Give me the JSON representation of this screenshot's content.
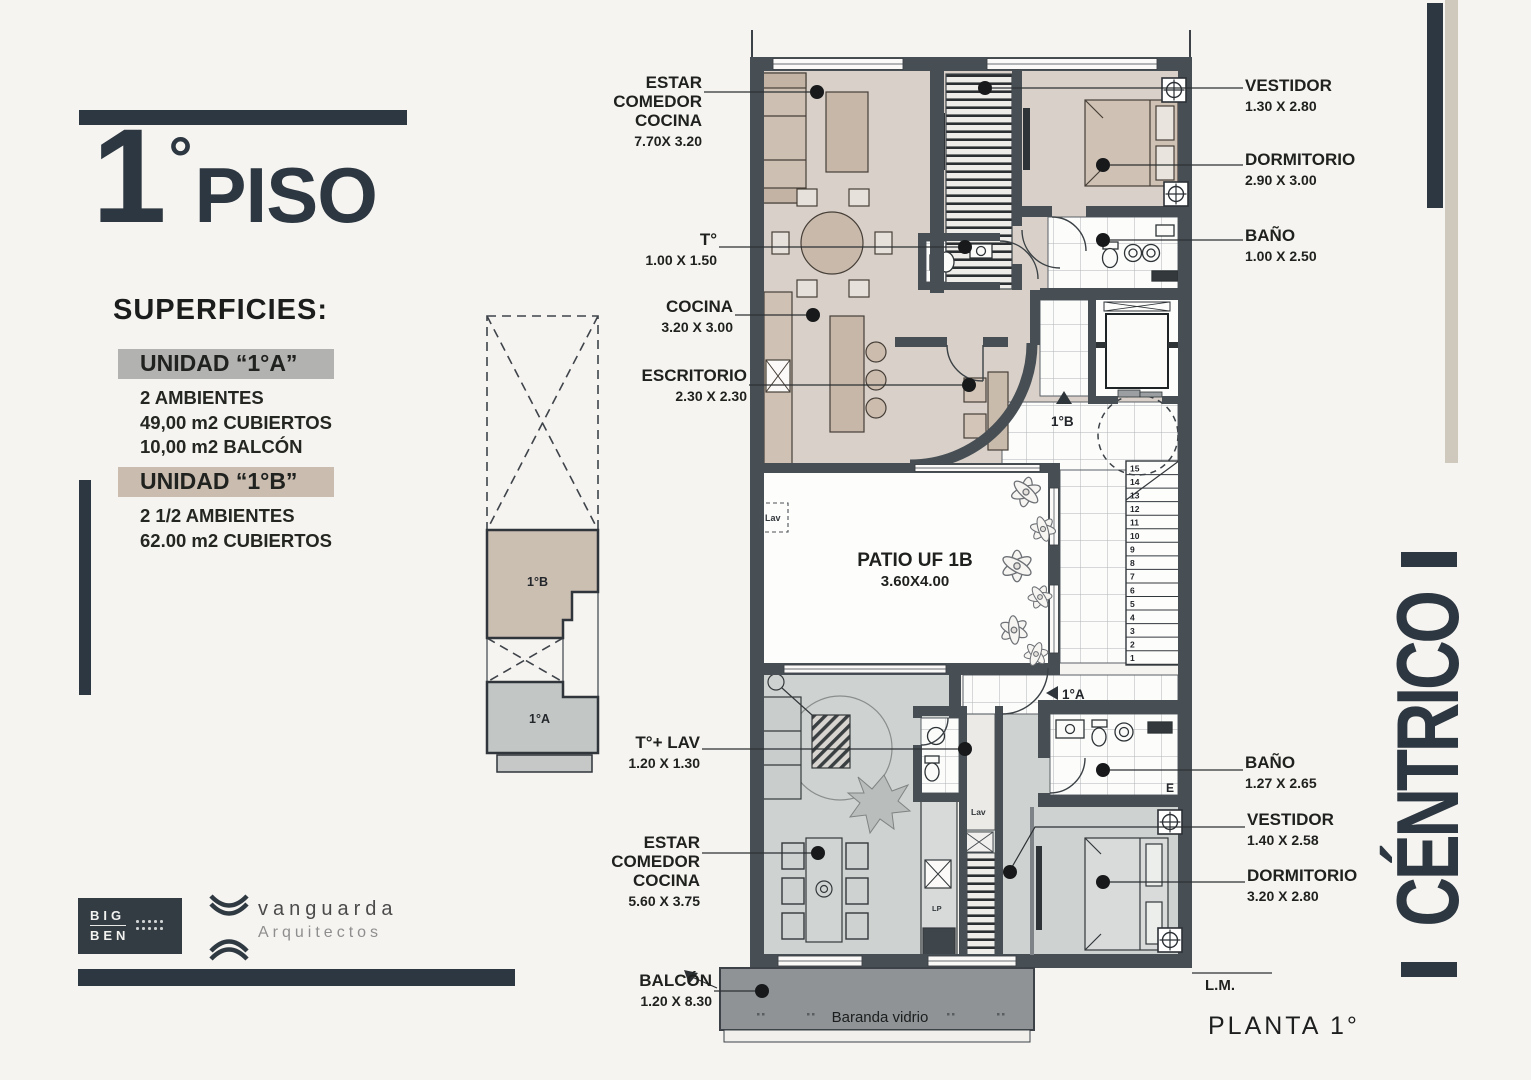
{
  "palette": {
    "accent_dark": "#2d3741",
    "wall": "#474f55",
    "floor_unit_b": "#d9d1c9",
    "floor_unit_a": "#ced2d0",
    "highlight_unit_a": "#b2b2b0",
    "highlight_unit_b": "#cabdb0",
    "balcony_band": "#8f9396",
    "tan_bar": "#cfc8bd"
  },
  "left_panel": {
    "title_digit": "1",
    "title_degree": "°",
    "title_word": "PISO",
    "superficies_heading": "SUPERFICIES:",
    "units": [
      {
        "header": "UNIDAD “1°A”",
        "highlight": "#b2b2b0",
        "lines": [
          "2 AMBIENTES",
          "49,00 m2 CUBIERTOS",
          "10,00 m2 BALCÓN"
        ]
      },
      {
        "header": "UNIDAD “1°B”",
        "highlight": "#cabdb0",
        "lines": [
          "2 1/2 AMBIENTES",
          "62.00 m2 CUBIERTOS"
        ]
      }
    ]
  },
  "keyplan": {
    "unit_b": "1°B",
    "unit_a": "1°A"
  },
  "logos": {
    "bigben_top": "BIG",
    "bigben_bottom": "BEN",
    "vanguarda_name": "vanguarda",
    "vanguarda_sub": "Arquitectos"
  },
  "side_banner": {
    "text": "CÉNTRICO"
  },
  "plan": {
    "labels": {
      "estar_1b": {
        "name": "ESTAR\nCOMEDOR\nCOCINA",
        "dim": "7.70X 3.20"
      },
      "t_1b": {
        "name": "T°",
        "dim": "1.00 X 1.50"
      },
      "cocina_1b": {
        "name": "COCINA",
        "dim": "3.20 X 3.00"
      },
      "escritorio_1b": {
        "name": "ESCRITORIO",
        "dim": "2.30 X 2.30"
      },
      "vestidor_1b": {
        "name": "VESTIDOR",
        "dim": "1.30 X 2.80"
      },
      "dormitorio_1b": {
        "name": "DORMITORIO",
        "dim": "2.90 X 3.00"
      },
      "bano_1b": {
        "name": "BAÑO",
        "dim": "1.00 X 2.50"
      },
      "patio": {
        "name": "PATIO UF 1B",
        "dim": "3.60X4.00"
      },
      "t_lav_1a": {
        "name": "T°+ LAV",
        "dim": "1.20 X 1.30"
      },
      "estar_1a": {
        "name": "ESTAR\nCOMEDOR\nCOCINA",
        "dim": "5.60 X 3.75"
      },
      "balcon": {
        "name": "BALCÓN",
        "dim": "1.20 X 8.30"
      },
      "bano_1a": {
        "name": "BAÑO",
        "dim": "1.27 X 2.65"
      },
      "vestidor_1a": {
        "name": "VESTIDOR",
        "dim": "1.40 X 2.58"
      },
      "dormitorio_1a": {
        "name": "DORMITORIO",
        "dim": "3.20 X 2.80"
      }
    },
    "annotations": {
      "unit_b_entry": "1°B",
      "unit_a_entry": "1°A",
      "lav_patio": "Lav",
      "lav_closet": "Lav",
      "lp": "LP",
      "e_mark": "E",
      "baranda": "Baranda vidrio",
      "lm": "L.M.",
      "planta": "PLANTA 1°"
    },
    "stairs": {
      "numbers": [
        1,
        2,
        3,
        4,
        5,
        6,
        7,
        8,
        9,
        10,
        11,
        12,
        13,
        14,
        15
      ]
    }
  }
}
